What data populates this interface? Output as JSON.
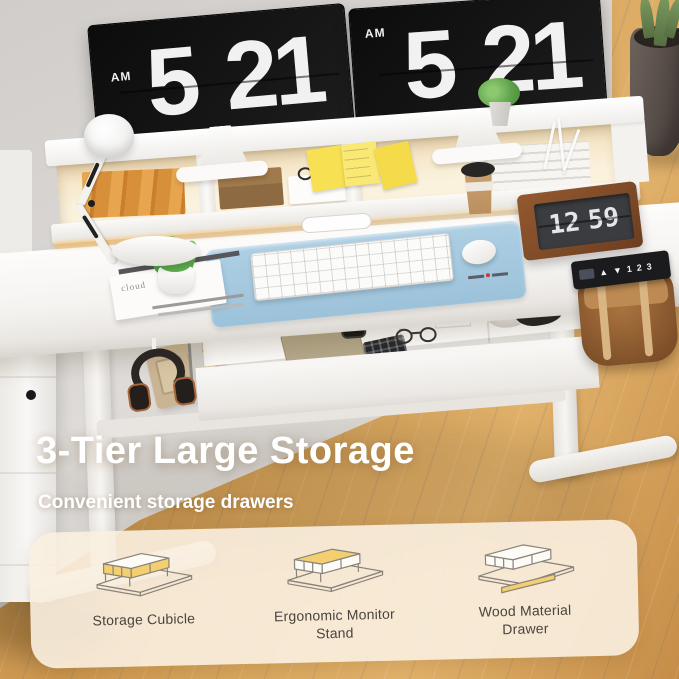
{
  "photo": {
    "monitors": [
      {
        "meridiem": "AM",
        "hour": "5",
        "minute": "21"
      },
      {
        "meridiem": "AM",
        "hour": "5",
        "minute": "21"
      }
    ],
    "flip_clock": {
      "hour": "12",
      "minute": "59"
    },
    "controller": {
      "buttons": [
        "▲",
        "▼",
        "1",
        "2",
        "3"
      ]
    },
    "book_text": "cloud"
  },
  "overlay": {
    "title": "3-Tier Large Storage",
    "subtitle": "Convenient storage drawers"
  },
  "features": [
    {
      "label": "Storage Cubicle"
    },
    {
      "label": "Ergonomic Monitor Stand"
    },
    {
      "label": "Wood Material Drawer"
    }
  ],
  "colors": {
    "accent_yellow": "#F3CF6F",
    "icon_stroke": "#8a837b",
    "panel_bg": "#F8F0E0",
    "mat_blue": "#A6C9DF",
    "wood_floor": "#D49B55",
    "label_text": "#4A443E",
    "title_text": "#FFFFFF"
  }
}
